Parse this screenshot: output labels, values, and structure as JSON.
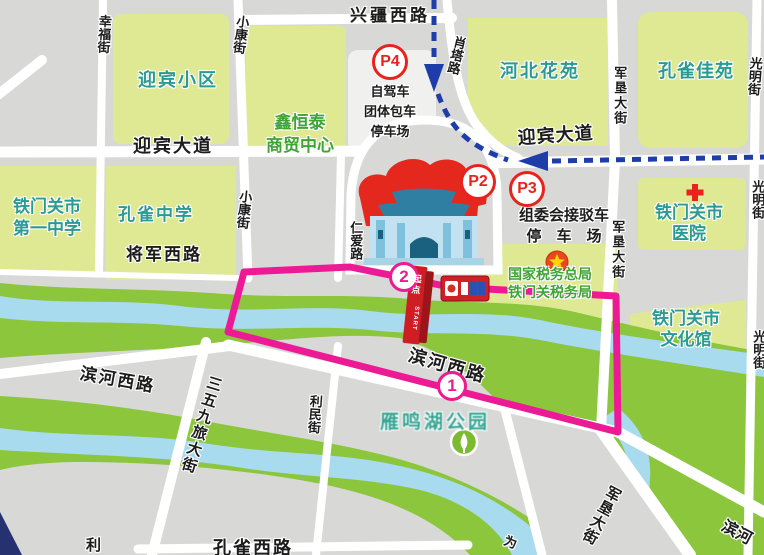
{
  "palette": {
    "route_pink": "#ed1a96",
    "shuttle_route_blue": "#1f3da8",
    "parking_marker_red": "#e8231d",
    "block_green": "#dfe993",
    "park_green": "#8cc63c",
    "river_blue": "#a8dbee"
  },
  "start_gate": {
    "label_cn": "起点",
    "label_en": "START"
  },
  "markers": [
    {
      "id": "p4",
      "type": "p",
      "text": "P4",
      "x": 390,
      "y": 62
    },
    {
      "id": "p2",
      "type": "p",
      "text": "P2",
      "x": 478,
      "y": 182
    },
    {
      "id": "p3",
      "type": "p",
      "text": "P3",
      "x": 527,
      "y": 189
    },
    {
      "id": "stage2",
      "type": "n",
      "text": "2",
      "x": 404,
      "y": 277
    },
    {
      "id": "stage1",
      "type": "n",
      "text": "1",
      "x": 452,
      "y": 386
    }
  ],
  "labels": [
    {
      "id": "xingfu-jie",
      "text": "幸福街",
      "x": 96,
      "y": 14,
      "o": "v",
      "c": "black",
      "fs": 13,
      "rot": 3
    },
    {
      "id": "xiaokang-jie-n",
      "text": "小康街",
      "x": 234,
      "y": 14,
      "o": "v",
      "c": "black",
      "fs": 13,
      "rot": 7
    },
    {
      "id": "xingjiang-xilu",
      "text": "兴疆西路",
      "x": 350,
      "y": 5,
      "c": "black",
      "fs": 17,
      "ls": 3
    },
    {
      "id": "xiaota-lu",
      "text": "肖塔路",
      "x": 452,
      "y": 34,
      "o": "v",
      "c": "black",
      "fs": 13,
      "rot": 13
    },
    {
      "id": "yingbin-xiaoqu",
      "text": "迎宾小区",
      "x": 138,
      "y": 69,
      "c": "teal",
      "fs": 18,
      "ls": 2
    },
    {
      "id": "hebei-huayuan",
      "text": "河北花苑",
      "x": 500,
      "y": 60,
      "c": "teal",
      "fs": 18,
      "ls": 2
    },
    {
      "id": "kongque-jiayuan",
      "text": "孔雀佳苑",
      "x": 658,
      "y": 60,
      "c": "teal",
      "fs": 18,
      "ls": 1
    },
    {
      "id": "junken-dajie-n",
      "text": "军垦大街",
      "x": 611,
      "y": 66,
      "o": "v",
      "c": "black",
      "fs": 13,
      "ls": 2
    },
    {
      "id": "guangming-jie-n",
      "text": "光明街",
      "x": 747,
      "y": 56,
      "o": "v",
      "c": "black",
      "fs": 13,
      "rot": 4
    },
    {
      "id": "p4-caption",
      "text": "自驾车\n团体包车\n停车场",
      "x": 364,
      "y": 82,
      "c": "black",
      "fs": 13,
      "lh": 1.55,
      "ctr": 1
    },
    {
      "id": "xinhengtai",
      "text": "鑫恒泰\n商贸中心",
      "x": 266,
      "y": 112,
      "c": "green",
      "fs": 17,
      "lh": 1.35,
      "ctr": 1
    },
    {
      "id": "yingbin-dadao-w",
      "text": "迎宾大道",
      "x": 133,
      "y": 135,
      "c": "black",
      "fs": 18,
      "ls": 2
    },
    {
      "id": "yingbin-dadao-e",
      "text": "迎宾大道",
      "x": 517,
      "y": 127,
      "c": "black",
      "fs": 18,
      "ls": 1,
      "rot": -4
    },
    {
      "id": "tmg-yizhong",
      "text": "铁门关市\n第一中学",
      "x": 13,
      "y": 196,
      "c": "teal",
      "fs": 17,
      "lh": 1.3
    },
    {
      "id": "kongque-zhongxue",
      "text": "孔雀中学",
      "x": 118,
      "y": 204,
      "c": "teal",
      "fs": 17,
      "ls": 2
    },
    {
      "id": "jiangjun-xilu",
      "text": "将军西路",
      "x": 126,
      "y": 244,
      "c": "black",
      "fs": 17,
      "ls": 2
    },
    {
      "id": "xiaokang-jie-m",
      "text": "小康街",
      "x": 237,
      "y": 189,
      "o": "v",
      "c": "black",
      "fs": 13,
      "rot": 6
    },
    {
      "id": "renai-lu",
      "text": "仁爱路",
      "x": 347,
      "y": 221,
      "o": "v",
      "c": "black",
      "fs": 13
    },
    {
      "id": "zuweihui",
      "text": "组委会接驳车\n停　车　场",
      "x": 519,
      "y": 205,
      "c": "black",
      "fs": 15,
      "lh": 1.4,
      "ctr": 1
    },
    {
      "id": "junken-dajie-m",
      "text": "军垦大街",
      "x": 609,
      "y": 220,
      "o": "v",
      "c": "black",
      "fs": 13,
      "ls": 2
    },
    {
      "id": "guangming-jie-m",
      "text": "光明街",
      "x": 749,
      "y": 180,
      "o": "v",
      "c": "black",
      "fs": 13
    },
    {
      "id": "tmg-hospital",
      "text": "铁门关市\n医院",
      "x": 655,
      "y": 202,
      "c": "teal",
      "fs": 17,
      "lh": 1.25,
      "ctr": 1
    },
    {
      "id": "guojia-shuiwu",
      "text": "国家税务总局\n铁门关税务局",
      "x": 508,
      "y": 266,
      "c": "green",
      "fs": 14,
      "lh": 1.25,
      "ctr": 1
    },
    {
      "id": "tmg-wenhuaguan",
      "text": "铁门关市\n文化馆",
      "x": 652,
      "y": 308,
      "c": "teal",
      "fs": 17,
      "lh": 1.25,
      "ctr": 1
    },
    {
      "id": "guangming-jie-s",
      "text": "光明街",
      "x": 750,
      "y": 330,
      "o": "v",
      "c": "black",
      "fs": 13
    },
    {
      "id": "binhe-xilu-c",
      "text": "滨河西路",
      "x": 412,
      "y": 344,
      "c": "black",
      "fs": 18,
      "ls": 2,
      "rot": 16
    },
    {
      "id": "yanminghu-gongyuan",
      "text": "雁鸣湖公园",
      "x": 380,
      "y": 411,
      "c": "park",
      "fs": 19,
      "ls": 3
    },
    {
      "id": "binhe-xilu-w",
      "text": "滨河西路",
      "x": 82,
      "y": 363,
      "c": "black",
      "fs": 17,
      "ls": 2,
      "rot": 10
    },
    {
      "id": "sanwujiulv-dajie",
      "text": "三五九旅大街",
      "x": 206,
      "y": 373,
      "o": "v",
      "c": "black",
      "fs": 15,
      "ls": 2,
      "rot": 17
    },
    {
      "id": "limin-jie",
      "text": "利民街",
      "x": 307,
      "y": 394,
      "o": "v",
      "c": "black",
      "fs": 13,
      "rot": 4
    },
    {
      "id": "junken-dajie-s",
      "text": "军垦大街",
      "x": 607,
      "y": 482,
      "o": "v",
      "c": "black",
      "fs": 15,
      "ls": 1,
      "rot": 28
    },
    {
      "id": "binhe-se",
      "text": "滨河",
      "x": 727,
      "y": 517,
      "c": "black",
      "fs": 16,
      "rot": 28
    },
    {
      "id": "kongque-xilu",
      "text": "孔雀西路",
      "x": 213,
      "y": 537,
      "c": "black",
      "fs": 18,
      "ls": 2
    },
    {
      "id": "limin-jie-cut",
      "text": "利",
      "x": 86,
      "y": 537,
      "c": "black",
      "fs": 15
    },
    {
      "id": "weimin-cut",
      "text": "为",
      "x": 507,
      "y": 533,
      "c": "black",
      "fs": 13,
      "rot": 20
    }
  ]
}
